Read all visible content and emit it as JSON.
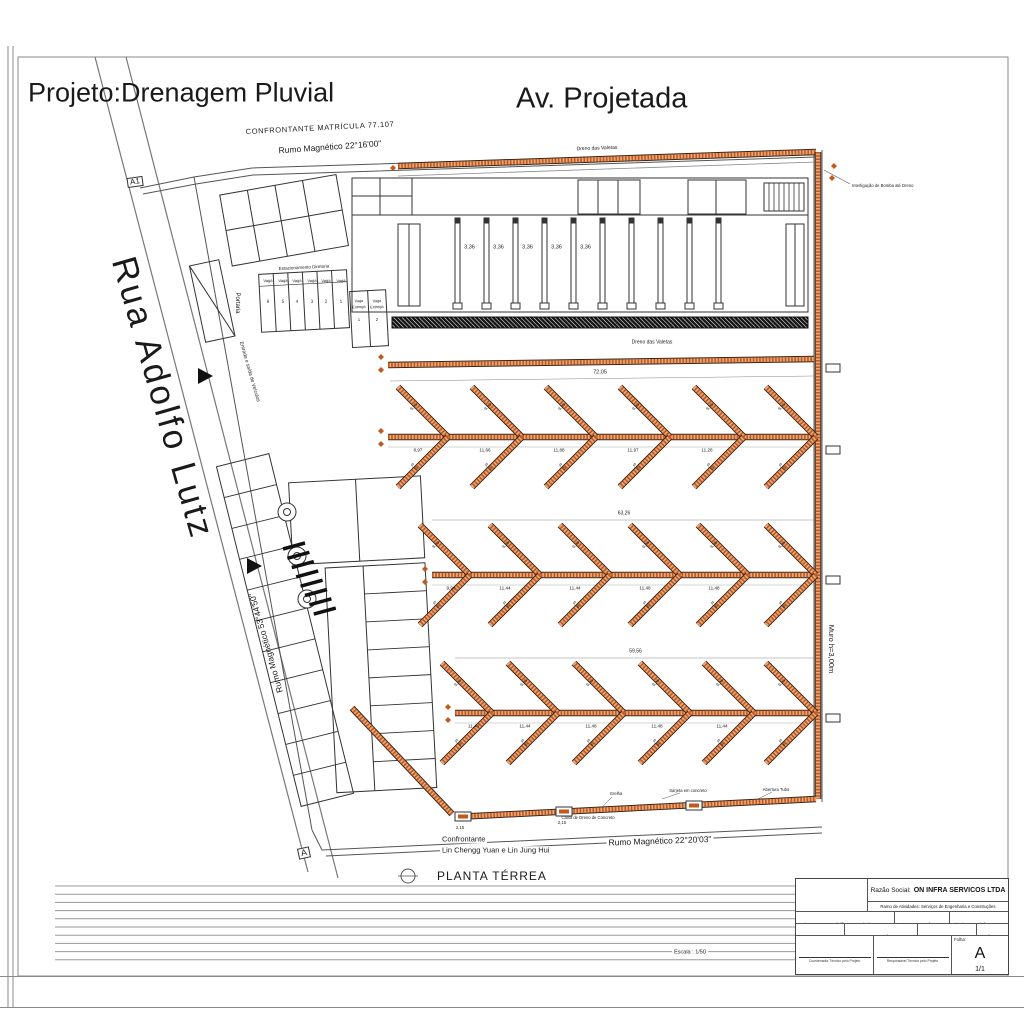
{
  "sheet": {
    "project_title": "Projeto:Drenagem Pluvial",
    "plan_name": "PLANTA TÉRREA",
    "scale": "Escala : 1/50",
    "marker_a1": "A1",
    "marker_a": "A"
  },
  "streets": {
    "top": "Av. Projetada",
    "left": "Rua Adolfo Lutz"
  },
  "boundaries": {
    "top_confrontante": "CONFRONTANTE MATRÍCULA 77.107",
    "top_rumo": "Rumo Magnético 22°16'00\"",
    "left_rumo": "Rumo Magnético 53°44'50\"",
    "bottom_rumo": "Rumo Magnético 22°20'03\"",
    "bottom_confrontante_line1": "Confrontante",
    "bottom_confrontante_line2": "Lin Chengg Yuan e Lin Jung Hui"
  },
  "site": {
    "portaria": "Portaria",
    "estacionamento": "Estacionamento Diretoria",
    "vaga_label": "Vaga",
    "vaga_numbers": [
      "6",
      "5",
      "4",
      "3",
      "2",
      "1"
    ],
    "vaga_entrega_words": [
      "Vaga",
      "Entrega"
    ],
    "vaga_entrega_numbers": [
      "1",
      "2"
    ],
    "entrada": "Entrada e saída de Veículos",
    "bay_dim": "3,36",
    "interligacao": "Interligação de Bomba até Dreno"
  },
  "drainage": {
    "color": "#c05a1f",
    "top_strip_label": "Dreno das Valetas",
    "mid_strip_label": "Dreno das Valetas",
    "mid_strip_dim": "72,05",
    "wall_label": "Muro h=3,00m",
    "rows": [
      {
        "dims": [
          "8,97",
          "11,66",
          "11,88",
          "11,97",
          "11,28"
        ],
        "diag_up": "9,29",
        "diag_down": "9,29",
        "overall": ""
      },
      {
        "dims": [
          "9,96",
          "11,44",
          "11,44",
          "11,48",
          "11,48"
        ],
        "diag_up": "9,26",
        "diag_down": "9,26",
        "overall": "63,26"
      },
      {
        "dims": [
          "11,44",
          "11,44",
          "11,48",
          "11,48",
          "11,44"
        ],
        "diag_up": "9,26",
        "diag_down": "9,26",
        "overall": "59,56"
      }
    ],
    "bottom": {
      "labels": [
        "Caixa de Dreno de Concreto",
        "Grelha",
        "Sarjeta em concreto",
        "Abertura Tubo"
      ],
      "box_dim": "2,15"
    }
  },
  "title_block": {
    "razao_social_label": "Razão Social:",
    "razao_social_value": "ON INFRA SERVICOS LTDA",
    "ramo": "Ramo de Atividades: Serviços de Engenharia e Construções",
    "endereco_label": "Endereço:",
    "endereco_value": "Rua Adolfo Lutz , nº s/n",
    "bairro_label": "Bairro:",
    "bairro_value": "Cezar de Souza",
    "cidade_label": "Cidade:",
    "cidade_value": "Mogi das Cruzes / SP",
    "cep_label": "CEP:",
    "cep_value": "08833-380",
    "cnpj_label": "CNPJ:",
    "cnpj_value": "44.803.740/0001-67",
    "ie_label": "IE:",
    "ie_value": "672.413.264.114",
    "versao_label": "Versão:",
    "versao_value": "00",
    "coordenador": "Coordenador Técnico pelo Projeto",
    "responsavel": "Responsável Técnico pelo Projeto",
    "folha_label": "Folha:",
    "folha_letter": "A",
    "folha_number": "1/1"
  }
}
